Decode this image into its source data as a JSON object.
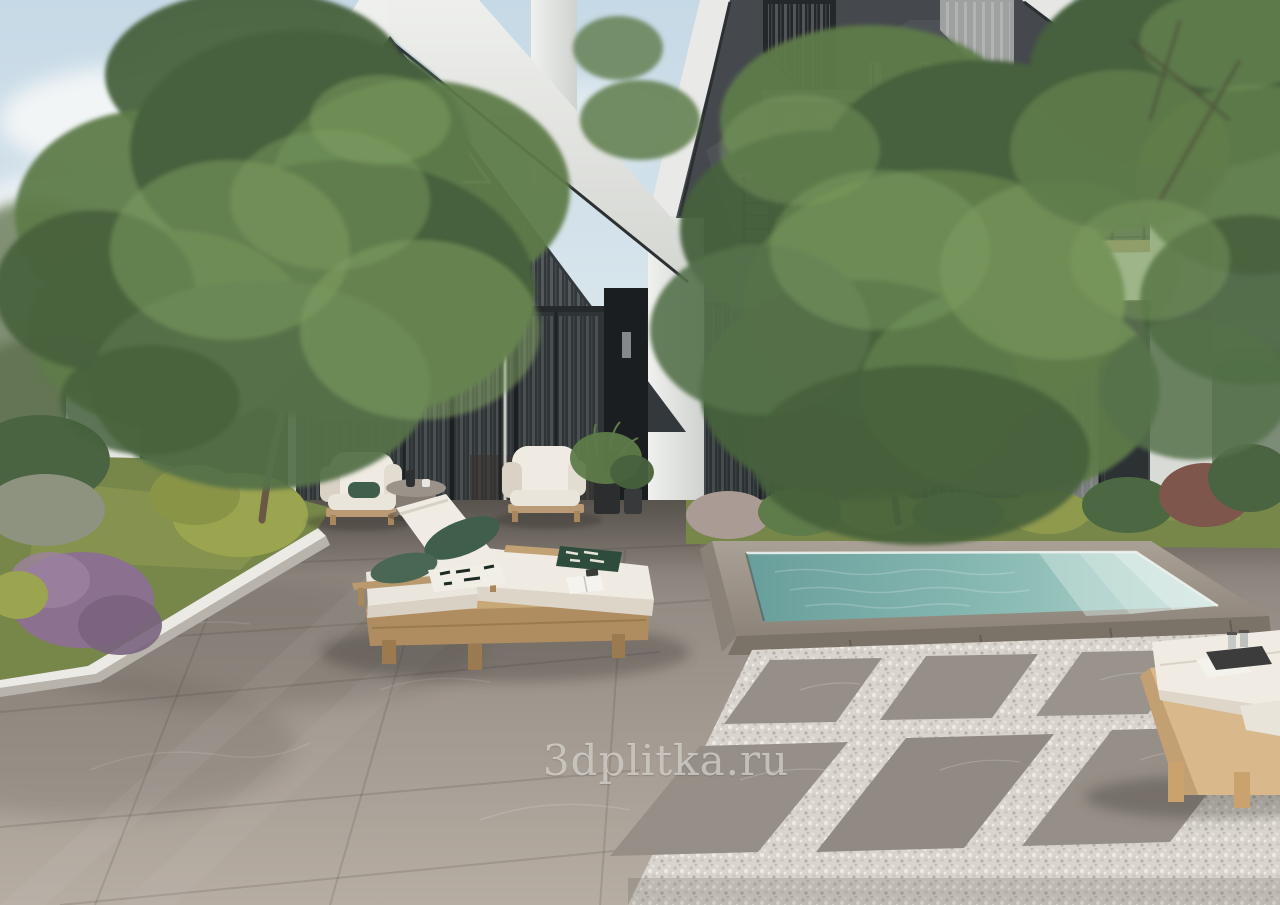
{
  "watermark": {
    "text": "3dplitka.ru"
  },
  "palette": {
    "sky_top": "#c6d9e6",
    "sky_bottom": "#e9f0f2",
    "cloud": "#f6f8f8",
    "facade_white": "#e6e7e4",
    "facade_white_shade": "#c9cbc8",
    "facade_dark": "#45494d",
    "facade_dark_shade": "#33373a",
    "glass_dark": "#2f3437",
    "glass_gable": "#33383c",
    "frame_dark": "#222629",
    "carport_dark": "#15171a",
    "water_deep": "#6fa7a3",
    "water_light": "#c2ddd8",
    "waterline": "#edf3ef",
    "pool_stone_top": "#a09788",
    "pool_stone_face": "#7b7268",
    "floor_far": "#6f6862",
    "floor_near": "#b6ada3",
    "gravel": "#d9d5ce",
    "paver": "#968f87",
    "curb": "#eceae4",
    "lawn": "#778749",
    "lawn_light": "#93a055",
    "hedge": "#4a6340",
    "bush_yellow": "#9ba44f",
    "bush_purple": "#8b7090",
    "bush_red": "#7f564b",
    "foliage_dark": "#47613c",
    "foliage_mid": "#5e7b4a",
    "foliage_light": "#7fa061",
    "trunk": "#6b5746",
    "wood": "#c9a878",
    "wood_dark": "#a8875c",
    "cushion": "#efebe2",
    "cushion_shade": "#d9d2c5",
    "pillow_green": "#3f5e4b",
    "towel_green": "#2e4c3c",
    "tray": "#3c3c3c",
    "watermark_color": "rgba(233,231,226,0.62)"
  }
}
